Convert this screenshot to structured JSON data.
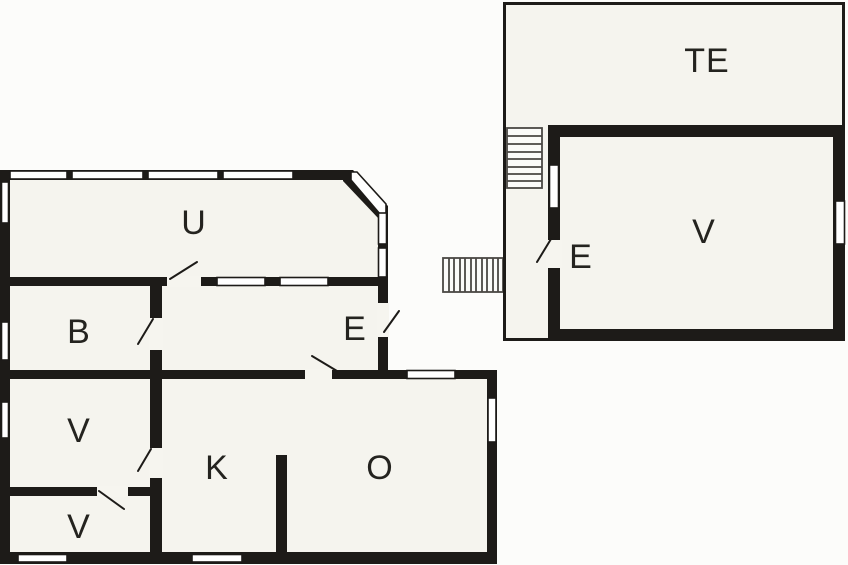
{
  "figure": {
    "kind": "floor plan",
    "buildings": [
      "main-house",
      "annex"
    ]
  },
  "colors": {
    "wall": "#1d1b18",
    "room_fill": "#f5f4ee",
    "background": "#fcfcfa",
    "label_text": "#24231f",
    "stair_line": "#4a4844"
  },
  "main_house": {
    "rooms": {
      "u": "U",
      "b": "B",
      "entry": "E",
      "v_middle": "V",
      "v_lower": "V",
      "k": "K",
      "o": "O"
    }
  },
  "annex": {
    "rooms": {
      "te": "TE",
      "v": "V",
      "entry": "E"
    }
  }
}
